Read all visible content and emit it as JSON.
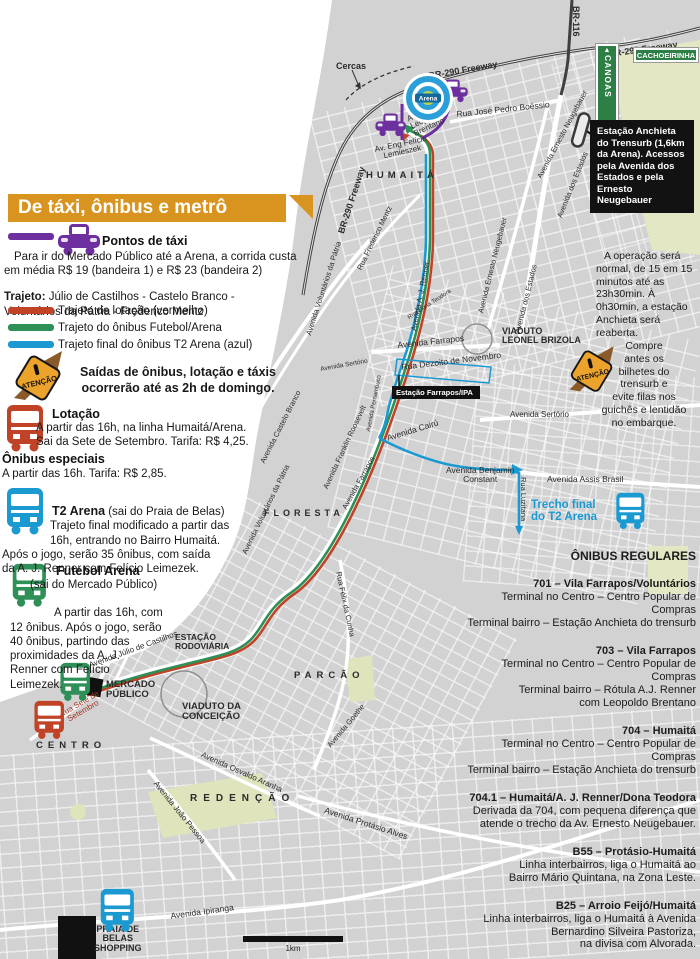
{
  "legend": {
    "title": "De táxi, ônibus e metrô",
    "taxi": {
      "color": "#6e2f9f",
      "title": "Pontos de táxi",
      "body": "Para ir do Mercado Público até a Arena, a corrida custa\nem média R$ 19 (bandeira 1) e R$ 23 (bandeira 2)",
      "trajeto_label": "Trajeto:",
      "trajeto": " Júlio de Castilhos - Castelo Branco -\nVoluntários da Pátria - Frederico Mentz"
    },
    "routes": [
      {
        "color": "#c04327",
        "label": "Trajeto de lotação (vermelho)"
      },
      {
        "color": "#2e8f57",
        "label": "Trajeto do ônibus Futebol/Arena"
      },
      {
        "color": "#1b9ad2",
        "label": "Trajeto final do ônibus T2 Arena (azul)"
      }
    ],
    "warning": "Saídas de ônibus, lotação e táxis\nocorrerão até as 2h de domingo.",
    "lotacao": {
      "title": "Lotação",
      "body": "A partir das 16h, na linha Humaitá/Arena.\nSai da Sete de Setembro. Tarifa: R$ 4,25."
    },
    "especiais": {
      "title": "Ônibus especiais",
      "body": "A partir das 16h. Tarifa: R$ 2,85."
    },
    "t2": {
      "title": "T2 Arena",
      "subtitle": " (sai do Praia de Belas)",
      "body": "Trajeto final modificado a partir das\n16h, entrando no Bairro Humaitá.\nApós o jogo, serão 35 ônibus, com saída\nda A. J. Renner com Felício Leimezek."
    },
    "futebol": {
      "title": "Futebol Arena",
      "subtitle": "(sai do Mercado Público)",
      "body": "A partir das 16h, com\n12 ônibus. Após o jogo, serão\n40 ônibus, partindo das\nproximidades da A. J.\nRenner com Felício\nLeimezek."
    }
  },
  "right": {
    "anchieta_box": "Estação Anchieta do Trensurb (1,6km da Arena). Acessos pela Avenida dos Estados e pela Ernesto Neugebauer",
    "operacao": "A operação será normal, de 15 em 15 minutos até as 23h30min. À 0h30min, a estação Anchieta será reaberta.",
    "compre": "Compre\nantes os\nbilhetes do\ntrensurb e\nevite filas nos\nguichês e lentidão\nno embarque.",
    "regulares": {
      "title": "ÔNIBUS REGULARES",
      "routes": [
        {
          "name": "701 – Vila Farrapos/Voluntários",
          "lines": [
            "Terminal no Centro – Centro Popular de",
            "Compras",
            "Terminal bairro – Estação Anchieta do trensurb"
          ]
        },
        {
          "name": "703 – Vila Farrapos",
          "lines": [
            "Terminal no Centro – Centro Popular de",
            "Compras",
            "Terminal bairro – Rótula A.J. Renner",
            "com Leopoldo Brentano"
          ]
        },
        {
          "name": "704 – Humaitá",
          "lines": [
            "Terminal no Centro – Centro Popular de",
            "Compras",
            "Terminal bairro – Estação Anchieta do trensurb"
          ]
        },
        {
          "name": "704.1 – Humaitá/A. J. Renner/Dona Teodora",
          "lines": [
            "Derivada da 704, com pequena diferença que",
            "atende o trecho da Av. Ernesto Neugebauer."
          ]
        },
        {
          "name": "B55 – Protásio-Humaitá",
          "lines": [
            "Linha interbairros, liga o Humaitá ao",
            "Bairro Mário Quintana, na Zona Leste."
          ]
        },
        {
          "name": "B25 – Arroio Feijó/Humaitá",
          "lines": [
            "Linha interbairros, liga o Humaitá à Avenida",
            "Bernardino Silveira Pastoriza,",
            "na divisa com Alvorada."
          ]
        }
      ]
    }
  },
  "map": {
    "signs": {
      "canoas": "CANOAS",
      "cachoeirinha": "CACHOEIRINHA"
    },
    "atencao_label": "ATENÇÃO",
    "arena_label": "Arena",
    "station_label": "Estação Farrapos/IPA",
    "scale_label": "1km",
    "colors": {
      "lotacao": "#c04327",
      "futebol": "#2e8f57",
      "t2": "#1b9ad2",
      "taxi": "#6e2f9f",
      "land": "#d2d2d2",
      "park": "#e0e5c2",
      "header_orange": "#d8941f"
    },
    "labels": [
      {
        "t": "BR-290 Freeway",
        "x": 337,
        "y": 232,
        "r": -72,
        "s": 9,
        "b": 1
      },
      {
        "t": "BR-290 Freeway",
        "x": 428,
        "y": 72,
        "r": -10,
        "s": 9,
        "b": 1
      },
      {
        "t": "BR-290 Freeway",
        "x": 608,
        "y": 50,
        "r": -8,
        "s": 9,
        "b": 1
      },
      {
        "t": "BR-116",
        "x": 580,
        "y": 6,
        "r": 90,
        "s": 9,
        "b": 1
      },
      {
        "t": "Cercas",
        "x": 336,
        "y": 62,
        "s": 9,
        "b": 1
      },
      {
        "t": "Rua José Pedro Boéssio",
        "x": 456,
        "y": 110,
        "r": -6,
        "s": 8.5
      },
      {
        "t": "Av. Padre\nLeopoldo\nBrentano",
        "x": 406,
        "y": 116,
        "r": -25,
        "s": 8
      },
      {
        "t": "Av. Eng Felício\nLemieszek",
        "x": 374,
        "y": 146,
        "r": -12,
        "s": 8,
        "align": "center"
      },
      {
        "t": "HUMAITÁ",
        "x": 366,
        "y": 171,
        "s": 9.5,
        "b": 1,
        "ls": 4
      },
      {
        "t": "Avenida Ernesto Neugebauer",
        "x": 536,
        "y": 176,
        "r": -62,
        "s": 7.5
      },
      {
        "t": "Avenida Ernesto Neugebauer",
        "x": 477,
        "y": 312,
        "r": -76,
        "s": 7.5
      },
      {
        "t": "Avenida dos Estados",
        "x": 556,
        "y": 216,
        "r": -68,
        "s": 7.5
      },
      {
        "t": "Avenida dos Estados",
        "x": 514,
        "y": 332,
        "r": -76,
        "s": 7.5
      },
      {
        "t": "Rua Frederico Mentz",
        "x": 356,
        "y": 268,
        "r": -64,
        "s": 7.5
      },
      {
        "t": "Avenida A. J. Renner",
        "x": 410,
        "y": 330,
        "r": -79,
        "s": 7.5
      },
      {
        "t": "Avenida Voluntários da Pátria",
        "x": 305,
        "y": 334,
        "r": -72,
        "s": 7.5
      },
      {
        "t": "Avenida Voluntários da Pátria",
        "x": 241,
        "y": 552,
        "r": -64,
        "s": 7.5
      },
      {
        "t": "Avenida Castelo Branco",
        "x": 259,
        "y": 461,
        "r": -63,
        "s": 7.5
      },
      {
        "t": "Avenida Sertório",
        "x": 320,
        "y": 367,
        "r": -10,
        "s": 6.5
      },
      {
        "t": "Avenida Sertório",
        "x": 510,
        "y": 411,
        "s": 8
      },
      {
        "t": "Avenida Franklin Roosevelt",
        "x": 322,
        "y": 487,
        "r": -65,
        "s": 7.5
      },
      {
        "t": "Avenida Farrapos",
        "x": 341,
        "y": 507,
        "r": -61,
        "s": 7.5
      },
      {
        "t": "Avenida Pernambuco",
        "x": 366,
        "y": 431,
        "r": -79,
        "s": 6
      },
      {
        "t": "Avenida Farrapos",
        "x": 397,
        "y": 341,
        "r": -6,
        "s": 8.5
      },
      {
        "t": "Rua Dona Teodora",
        "x": 407,
        "y": 316,
        "r": -33,
        "s": 6
      },
      {
        "t": "VIADUTO\nLEONEL BRIZOLA",
        "x": 502,
        "y": 327,
        "s": 9,
        "b": 1
      },
      {
        "t": "Rua Dezoito de Novembro",
        "x": 401,
        "y": 363,
        "r": -7,
        "s": 8.5
      },
      {
        "t": "Avenida Cairú",
        "x": 386,
        "y": 434,
        "r": -17,
        "s": 8.5
      },
      {
        "t": "Avenida Benjamin\nConstant",
        "x": 446,
        "y": 466,
        "s": 8.5,
        "align": "center"
      },
      {
        "t": "Rua Luzitana",
        "x": 527,
        "y": 477,
        "r": 90,
        "s": 7.5
      },
      {
        "t": "Avenida Assis Brasil",
        "x": 547,
        "y": 475,
        "s": 8.5
      },
      {
        "t": "Trecho final\ndo T2 Arena",
        "x": 531,
        "y": 500,
        "s": 11.5,
        "b": 1,
        "c": "#1b9ad2"
      },
      {
        "t": "FLORESTA",
        "x": 264,
        "y": 509,
        "s": 9,
        "b": 1,
        "ls": 4
      },
      {
        "t": "Rua Félix da Cunha",
        "x": 342,
        "y": 571,
        "r": 78,
        "s": 7.5
      },
      {
        "t": "PARCÃO",
        "x": 294,
        "y": 671,
        "s": 9.5,
        "b": 1,
        "ls": 5
      },
      {
        "t": "Avenida Goethe",
        "x": 326,
        "y": 744,
        "r": -50,
        "s": 7.5
      },
      {
        "t": "Avenida Júlio de Castilhos",
        "x": 88,
        "y": 662,
        "r": -20,
        "s": 8
      },
      {
        "t": "ESTAÇÃO\nRODOVIÁRIA",
        "x": 175,
        "y": 633,
        "s": 8.5,
        "b": 1
      },
      {
        "t": "MERCADO\nPÚBLICO",
        "x": 106,
        "y": 680,
        "s": 9.5,
        "b": 1
      },
      {
        "t": "VIADUTO DA\nCONCEIÇÃO",
        "x": 182,
        "y": 702,
        "s": 9.5,
        "b": 1
      },
      {
        "t": "Rua Sete de\nSetembro",
        "x": 58,
        "y": 712,
        "r": -30,
        "s": 8,
        "c": "#a33425",
        "align": "center"
      },
      {
        "t": "CENTRO",
        "x": 36,
        "y": 741,
        "s": 9.5,
        "b": 1,
        "ls": 5
      },
      {
        "t": "Avenida Osvaldo Aranha",
        "x": 203,
        "y": 751,
        "r": 24,
        "s": 8
      },
      {
        "t": "Avenida João Pessoa",
        "x": 158,
        "y": 780,
        "r": 51,
        "s": 8
      },
      {
        "t": "REDENÇÃO",
        "x": 190,
        "y": 794,
        "s": 10,
        "b": 1,
        "ls": 6
      },
      {
        "t": "Avenida Protásio Alves",
        "x": 326,
        "y": 806,
        "r": 18,
        "s": 8.5
      },
      {
        "t": "Avenida Ipiranga",
        "x": 170,
        "y": 912,
        "r": -8,
        "s": 8.5
      },
      {
        "t": "PRAIA DE\nBELAS\nSHOPPING",
        "x": 94,
        "y": 925,
        "s": 9,
        "b": 1,
        "align": "center"
      }
    ],
    "icons": [
      {
        "type": "taxi",
        "name": "taxi-icon-legend",
        "x": 56,
        "y": 222,
        "s": 1
      },
      {
        "type": "taxi",
        "name": "taxi-icon-arena",
        "x": 436,
        "y": 78,
        "s": 0.72
      },
      {
        "type": "taxi",
        "name": "taxi-icon-brentano",
        "x": 374,
        "y": 112,
        "s": 0.72
      },
      {
        "type": "atencao",
        "name": "attention-icon-legend",
        "x": 8,
        "y": 342,
        "s": 1
      },
      {
        "type": "atencao",
        "name": "attention-icon-trensurb",
        "x": 564,
        "y": 338,
        "s": 0.92
      },
      {
        "type": "bus",
        "name": "bus-icon-lotacao-legend",
        "x": 4,
        "y": 404,
        "s": 1,
        "color": "#c04327"
      },
      {
        "type": "bus",
        "name": "bus-icon-t2-legend",
        "x": 4,
        "y": 487,
        "s": 1,
        "color": "#1b9ad2"
      },
      {
        "type": "bus",
        "name": "bus-icon-futebol-legend",
        "x": 10,
        "y": 563,
        "s": 0.92,
        "color": "#2e8f57"
      },
      {
        "type": "bus",
        "name": "bus-icon-futebol-map",
        "x": 58,
        "y": 662,
        "s": 0.82,
        "color": "#2e8f57"
      },
      {
        "type": "bus",
        "name": "bus-icon-lotacao-map",
        "x": 32,
        "y": 700,
        "s": 0.82,
        "color": "#c04327"
      },
      {
        "type": "bus",
        "name": "bus-icon-t2-map",
        "x": 614,
        "y": 492,
        "s": 0.78,
        "color": "#1b9ad2"
      },
      {
        "type": "bus",
        "name": "bus-icon-praia-map",
        "x": 98,
        "y": 888,
        "s": 0.92,
        "color": "#1b9ad2"
      },
      {
        "type": "arena",
        "name": "arena-stadium-icon",
        "x": 402,
        "y": 72,
        "s": 1
      },
      {
        "type": "pill",
        "name": "trensurb-station-icon",
        "x": 570,
        "y": 110,
        "s": 1
      }
    ]
  }
}
